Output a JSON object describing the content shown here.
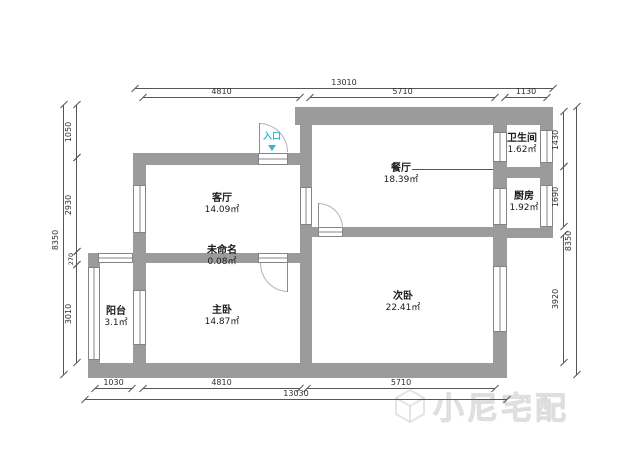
{
  "rooms": {
    "living": {
      "name": "客厅",
      "area": "14.09㎡"
    },
    "dining": {
      "name": "餐厅",
      "area": "18.39㎡"
    },
    "bathroom": {
      "name": "卫生间",
      "area": "1.62㎡"
    },
    "kitchen": {
      "name": "厨房",
      "area": "1.92㎡"
    },
    "second_bedroom": {
      "name": "次卧",
      "area": "22.41㎡"
    },
    "master_bedroom": {
      "name": "主卧",
      "area": "14.87㎡"
    },
    "balcony": {
      "name": "阳台",
      "area": "3.1㎡"
    },
    "unnamed": {
      "name": "未命名",
      "area": "0.08㎡"
    }
  },
  "entrance": {
    "label": "入口"
  },
  "dimensions": {
    "top": {
      "overall": "13010",
      "segments": [
        "4810",
        "5710",
        "1130"
      ]
    },
    "bottom": {
      "overall": "13030",
      "segments": [
        "1030",
        "4810",
        "5710"
      ]
    },
    "left": {
      "overall": "8350",
      "segments": [
        "1050",
        "2930",
        "270",
        "3010"
      ]
    },
    "right": {
      "overall": "8350",
      "segments": [
        "1430",
        "1690",
        "3920"
      ]
    }
  },
  "watermark": {
    "brand": "小尼宅配"
  },
  "colors": {
    "wall": "#9b9b9b",
    "entrance_accent": "#35b6c9",
    "dimension_line": "#565656"
  }
}
